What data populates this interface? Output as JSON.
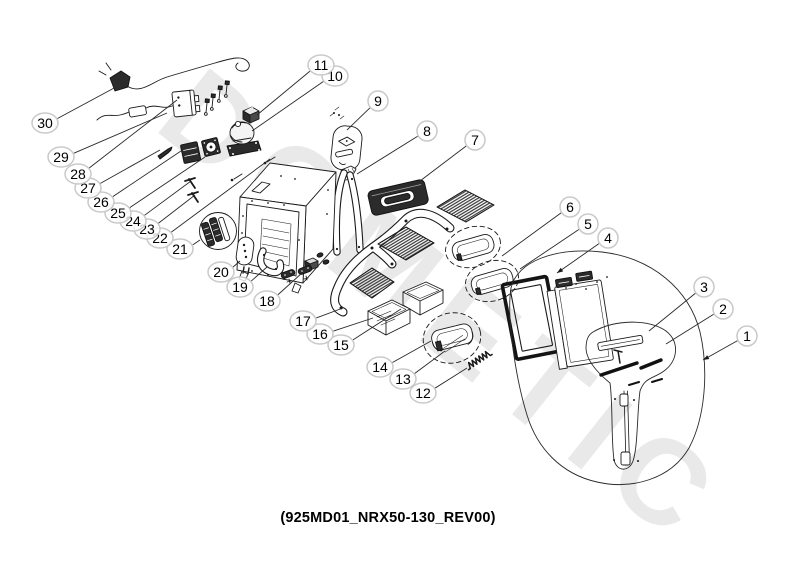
{
  "diagram": {
    "watermark": "DOMETIC",
    "caption": "(925MD01_NRX50-130_REV00)",
    "callouts": [
      {
        "n": "1",
        "x": 747,
        "y": 336,
        "ex": 703,
        "ey": 360,
        "arrow": true
      },
      {
        "n": "2",
        "x": 723,
        "y": 309,
        "ex": 666,
        "ey": 344
      },
      {
        "n": "3",
        "x": 704,
        "y": 287,
        "ex": 649,
        "ey": 331
      },
      {
        "n": "4",
        "x": 608,
        "y": 238,
        "ex": 557,
        "ey": 273,
        "arrow": true
      },
      {
        "n": "5",
        "x": 588,
        "y": 224,
        "ex": 520,
        "ey": 269
      },
      {
        "n": "6",
        "x": 570,
        "y": 207,
        "ex": 502,
        "ey": 256
      },
      {
        "n": "7",
        "x": 475,
        "y": 140,
        "ex": 416,
        "ey": 184
      },
      {
        "n": "8",
        "x": 427,
        "y": 131,
        "ex": 357,
        "ey": 174
      },
      {
        "n": "9",
        "x": 378,
        "y": 101,
        "ex": 347,
        "ey": 130
      },
      {
        "n": "10",
        "x": 335,
        "y": 76,
        "ex": 252,
        "ey": 131
      },
      {
        "n": "11",
        "x": 321,
        "y": 65,
        "ex": 257,
        "ey": 115
      },
      {
        "n": "12",
        "x": 423,
        "y": 393,
        "ex": 467,
        "ey": 368
      },
      {
        "n": "13",
        "x": 403,
        "y": 379,
        "ex": 445,
        "ey": 351
      },
      {
        "n": "14",
        "x": 380,
        "y": 367,
        "ex": 431,
        "ey": 341
      },
      {
        "n": "15",
        "x": 341,
        "y": 345,
        "ex": 401,
        "ey": 309
      },
      {
        "n": "16",
        "x": 320,
        "y": 334,
        "ex": 373,
        "ey": 318
      },
      {
        "n": "17",
        "x": 303,
        "y": 321,
        "ex": 343,
        "ey": 308
      },
      {
        "n": "18",
        "x": 267,
        "y": 301,
        "ex": 302,
        "ey": 273
      },
      {
        "n": "19",
        "x": 240,
        "y": 287,
        "ex": 267,
        "ey": 267
      },
      {
        "n": "20",
        "x": 221,
        "y": 272,
        "ex": 240,
        "ey": 261
      },
      {
        "n": "21",
        "x": 180,
        "y": 249,
        "ex": 200,
        "ey": 240
      },
      {
        "n": "22",
        "x": 160,
        "y": 238,
        "ex": 270,
        "ey": 159
      },
      {
        "n": "23",
        "x": 147,
        "y": 229,
        "ex": 195,
        "ey": 195
      },
      {
        "n": "24",
        "x": 133,
        "y": 221,
        "ex": 191,
        "ey": 181
      },
      {
        "n": "25",
        "x": 118,
        "y": 213,
        "ex": 205,
        "ey": 157
      },
      {
        "n": "26",
        "x": 101,
        "y": 202,
        "ex": 181,
        "ey": 151
      },
      {
        "n": "27",
        "x": 88,
        "y": 188,
        "ex": 160,
        "ey": 150
      },
      {
        "n": "28",
        "x": 78,
        "y": 174,
        "ex": 177,
        "ey": 100
      },
      {
        "n": "29",
        "x": 61,
        "y": 157,
        "ex": 167,
        "ey": 113
      },
      {
        "n": "30",
        "x": 45,
        "y": 123,
        "ex": 116,
        "ey": 87
      }
    ]
  }
}
